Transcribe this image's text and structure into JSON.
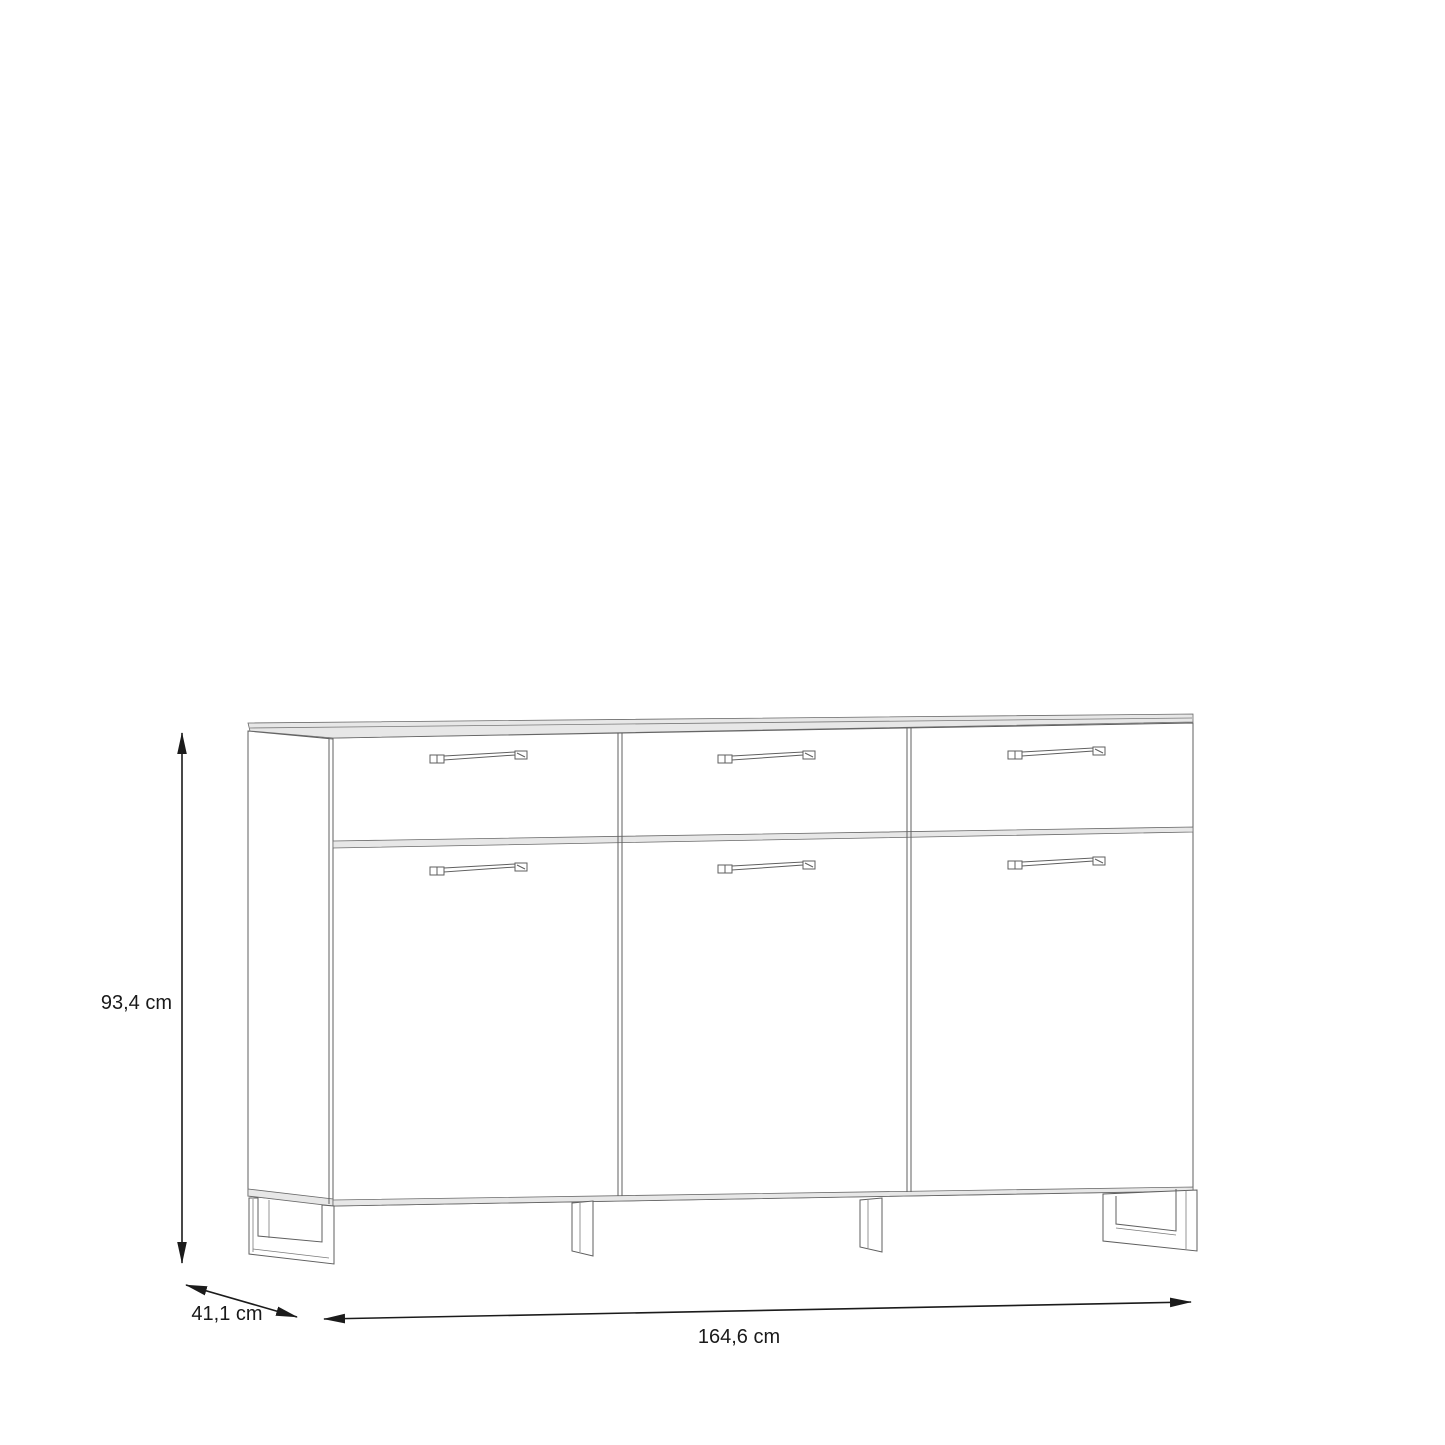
{
  "diagram": {
    "kind": "furniture-dimension-drawing",
    "subject": "sideboard with three drawers above three doors, on metal sled feet",
    "colors": {
      "background": "#ffffff",
      "outline": "#5f5f5f",
      "shading": "#e7e7e7",
      "dimension": "#1b1b1b"
    },
    "dimensions": {
      "height_label": "93,4 cm",
      "depth_label": "41,1 cm",
      "width_label": "164,6 cm"
    }
  }
}
